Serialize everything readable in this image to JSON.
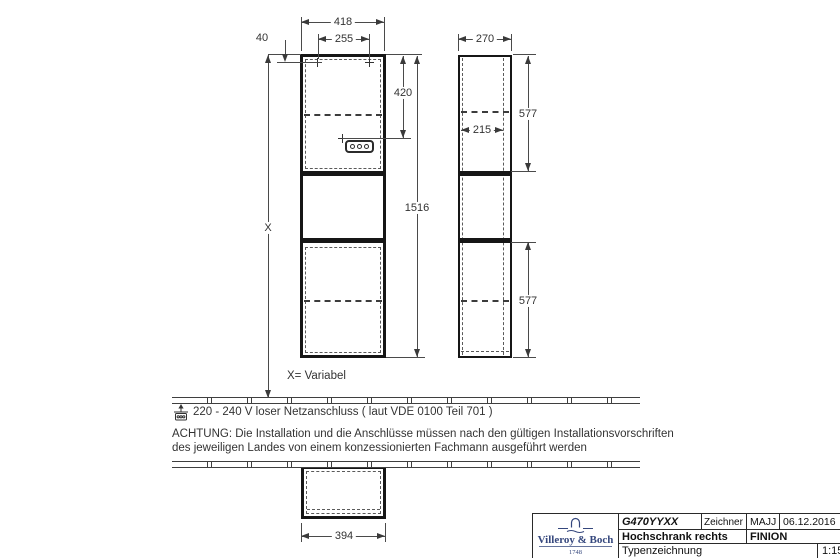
{
  "drawing": {
    "dims": {
      "front_width": "418",
      "hole_spacing": "255",
      "hole_offset_top": "40",
      "socket_drop": "420",
      "cabinet_height": "1516",
      "depth": "270",
      "shelf_depth": "215",
      "upper_section": "577",
      "lower_section": "577",
      "base_width": "394",
      "x_label": "X"
    },
    "labels": {
      "x_note": "X= Variabel"
    },
    "notes": {
      "power": "220 - 240 V loser Netzanschluss ( laut VDE 0100 Teil 701 )",
      "warning_line1": "ACHTUNG: Die Installation und die Anschlüsse müssen nach den gültigen Installationsvorschriften",
      "warning_line2": "des jeweiligen Landes von einem konzessionierten Fachmann ausgeführt werden"
    }
  },
  "title_block": {
    "article_number": "G470YYXX",
    "drafter_label": "Zeichner",
    "drafter": "MAJJ",
    "date": "06.12.2016",
    "product": "Hochschrank rechts",
    "series": "FINION",
    "drawing_type": "Typenzeichnung",
    "scale": "1:15",
    "brand": "Villeroy & Boch",
    "brand_year": "1748"
  },
  "colors": {
    "line": "#3a3a3a",
    "heavy_line": "#161616",
    "text": "#333333",
    "brand_navy": "#35477d"
  }
}
